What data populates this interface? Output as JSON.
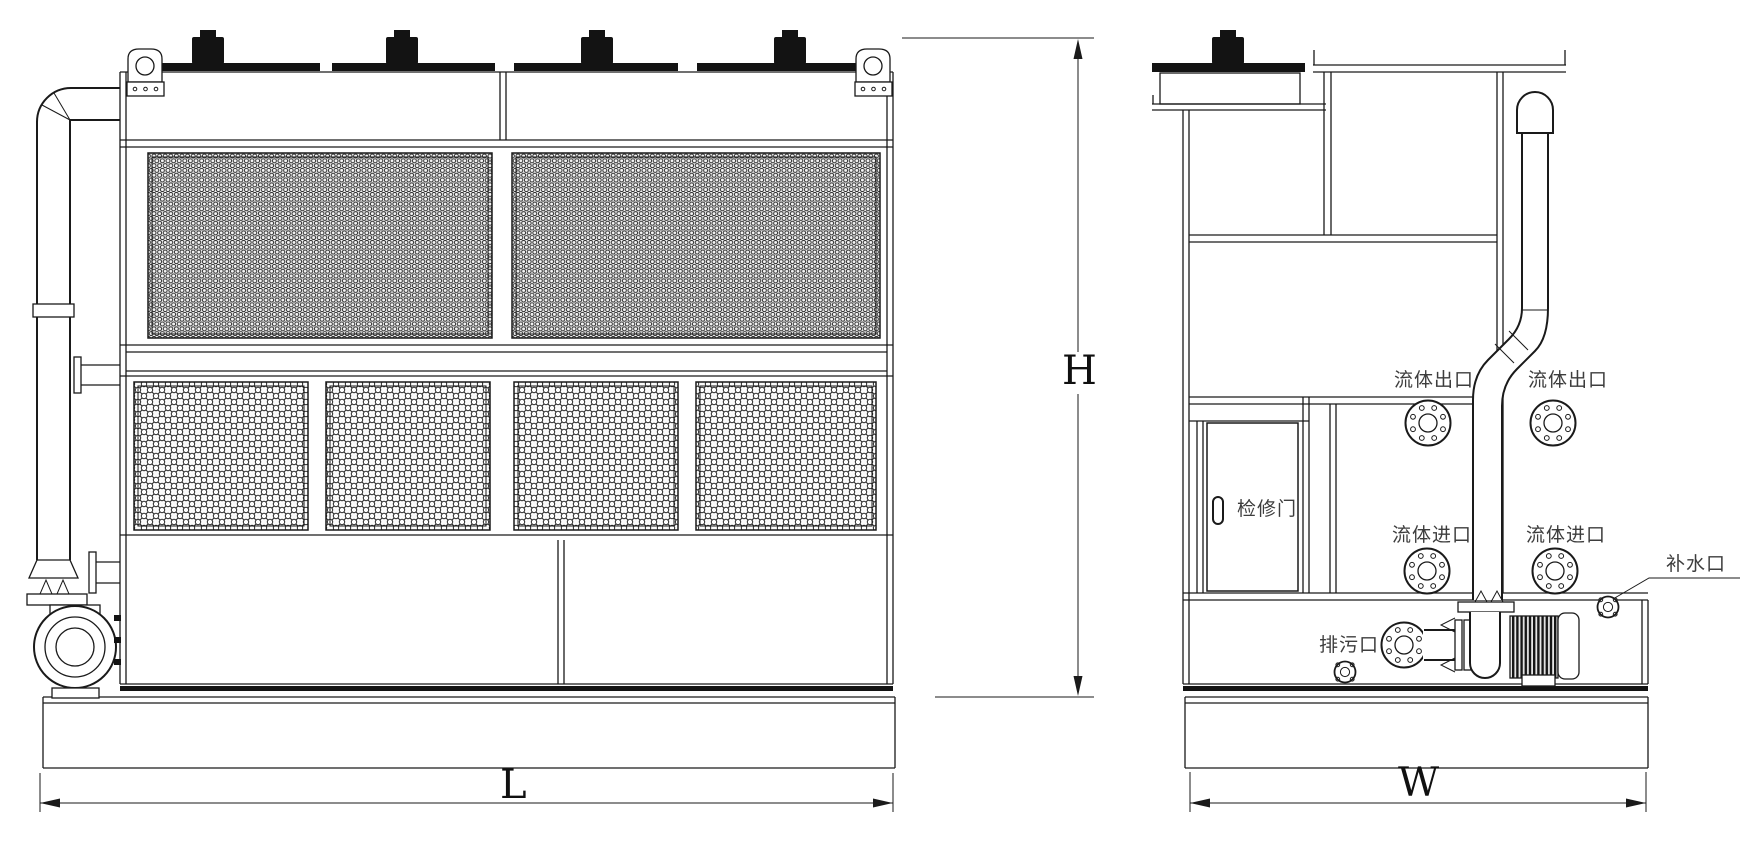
{
  "front_view": {
    "dim_length_label": "L",
    "dim_height_label": "H"
  },
  "side_view": {
    "dim_width_label": "W",
    "fluid_outlet_label_1": "流体出口",
    "fluid_outlet_label_2": "流体出口",
    "fluid_inlet_label_1": "流体进口",
    "fluid_inlet_label_2": "流体进口",
    "access_door_label": "检修门",
    "drain_port_label": "排污口",
    "makeup_water_label": "补水口"
  },
  "colors": {
    "line": "#1a1a1a",
    "background": "#ffffff",
    "label_text": "#3d3d3d",
    "dark_fill": "#131313"
  }
}
